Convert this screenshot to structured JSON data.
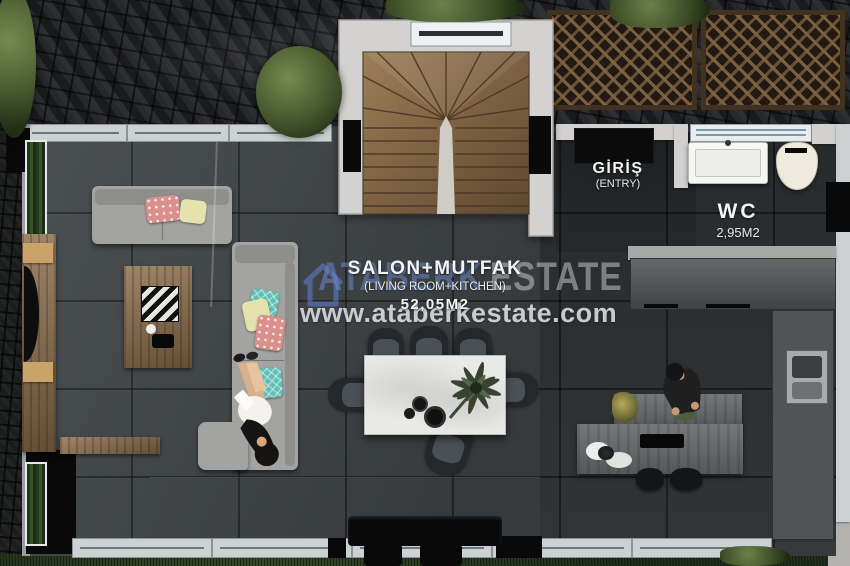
{
  "brand": {
    "logo_icon": "house-logo-icon",
    "ghost_primary": "ATABERK",
    "ghost_secondary": "ESTATE",
    "website": "www.ataberkestate.com",
    "accent_blue": "#6e8ed2"
  },
  "rooms": {
    "living_kitchen": {
      "title": "SALON+MUTFAK",
      "subtitle": "(LIVING ROOM+KITCHEN)",
      "area": "52,05M2"
    },
    "entry": {
      "title": "GİRİŞ",
      "subtitle": "(ENTRY)"
    },
    "wc": {
      "title": "WC",
      "area": "2,95M2"
    }
  },
  "palette": {
    "floor_tile": "#404548",
    "wall": "#d2d1d0",
    "stair_wood": "#7d6142",
    "pillow_coral": "#d98f8c",
    "pillow_yellow": "#e6e2ad",
    "pillow_teal": "#5fc0b4",
    "label_text": "#f4f4f4"
  }
}
